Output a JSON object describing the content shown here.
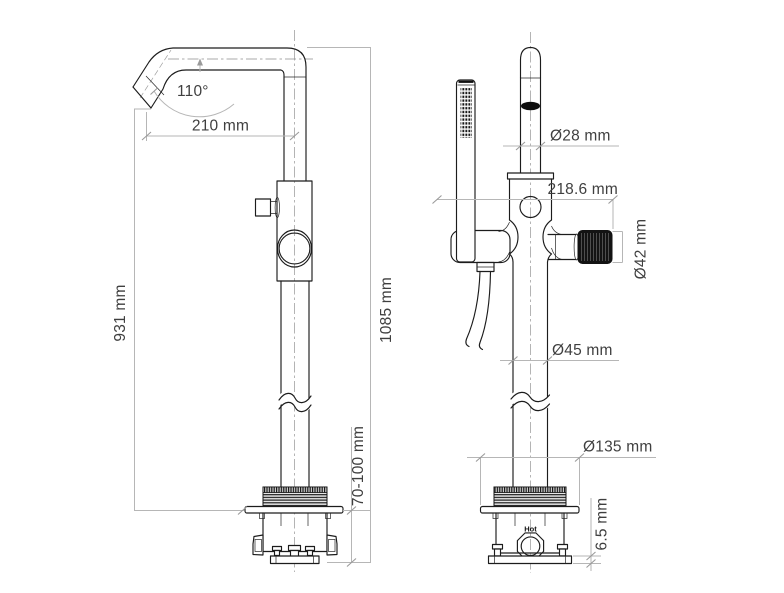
{
  "dims": {
    "angle": "110°",
    "reach": "210 mm",
    "spout_height": "931 mm",
    "total_height": "1085 mm",
    "install_depth": "70-100 mm",
    "spout_dia": "Ø28 mm",
    "total_depth": "218.6 mm",
    "knob_dia": "Ø42 mm",
    "column_dia": "Ø45 mm",
    "flange_dia": "Ø135 mm",
    "plate_thickness": "6.5 mm",
    "hot": "Hot"
  },
  "colors": {
    "line": "#1c1c1c",
    "dimension_line": "#b6b6b6",
    "dimension_text": "#3f3f3f",
    "fill_black": "#131313",
    "background": "#ffffff"
  }
}
